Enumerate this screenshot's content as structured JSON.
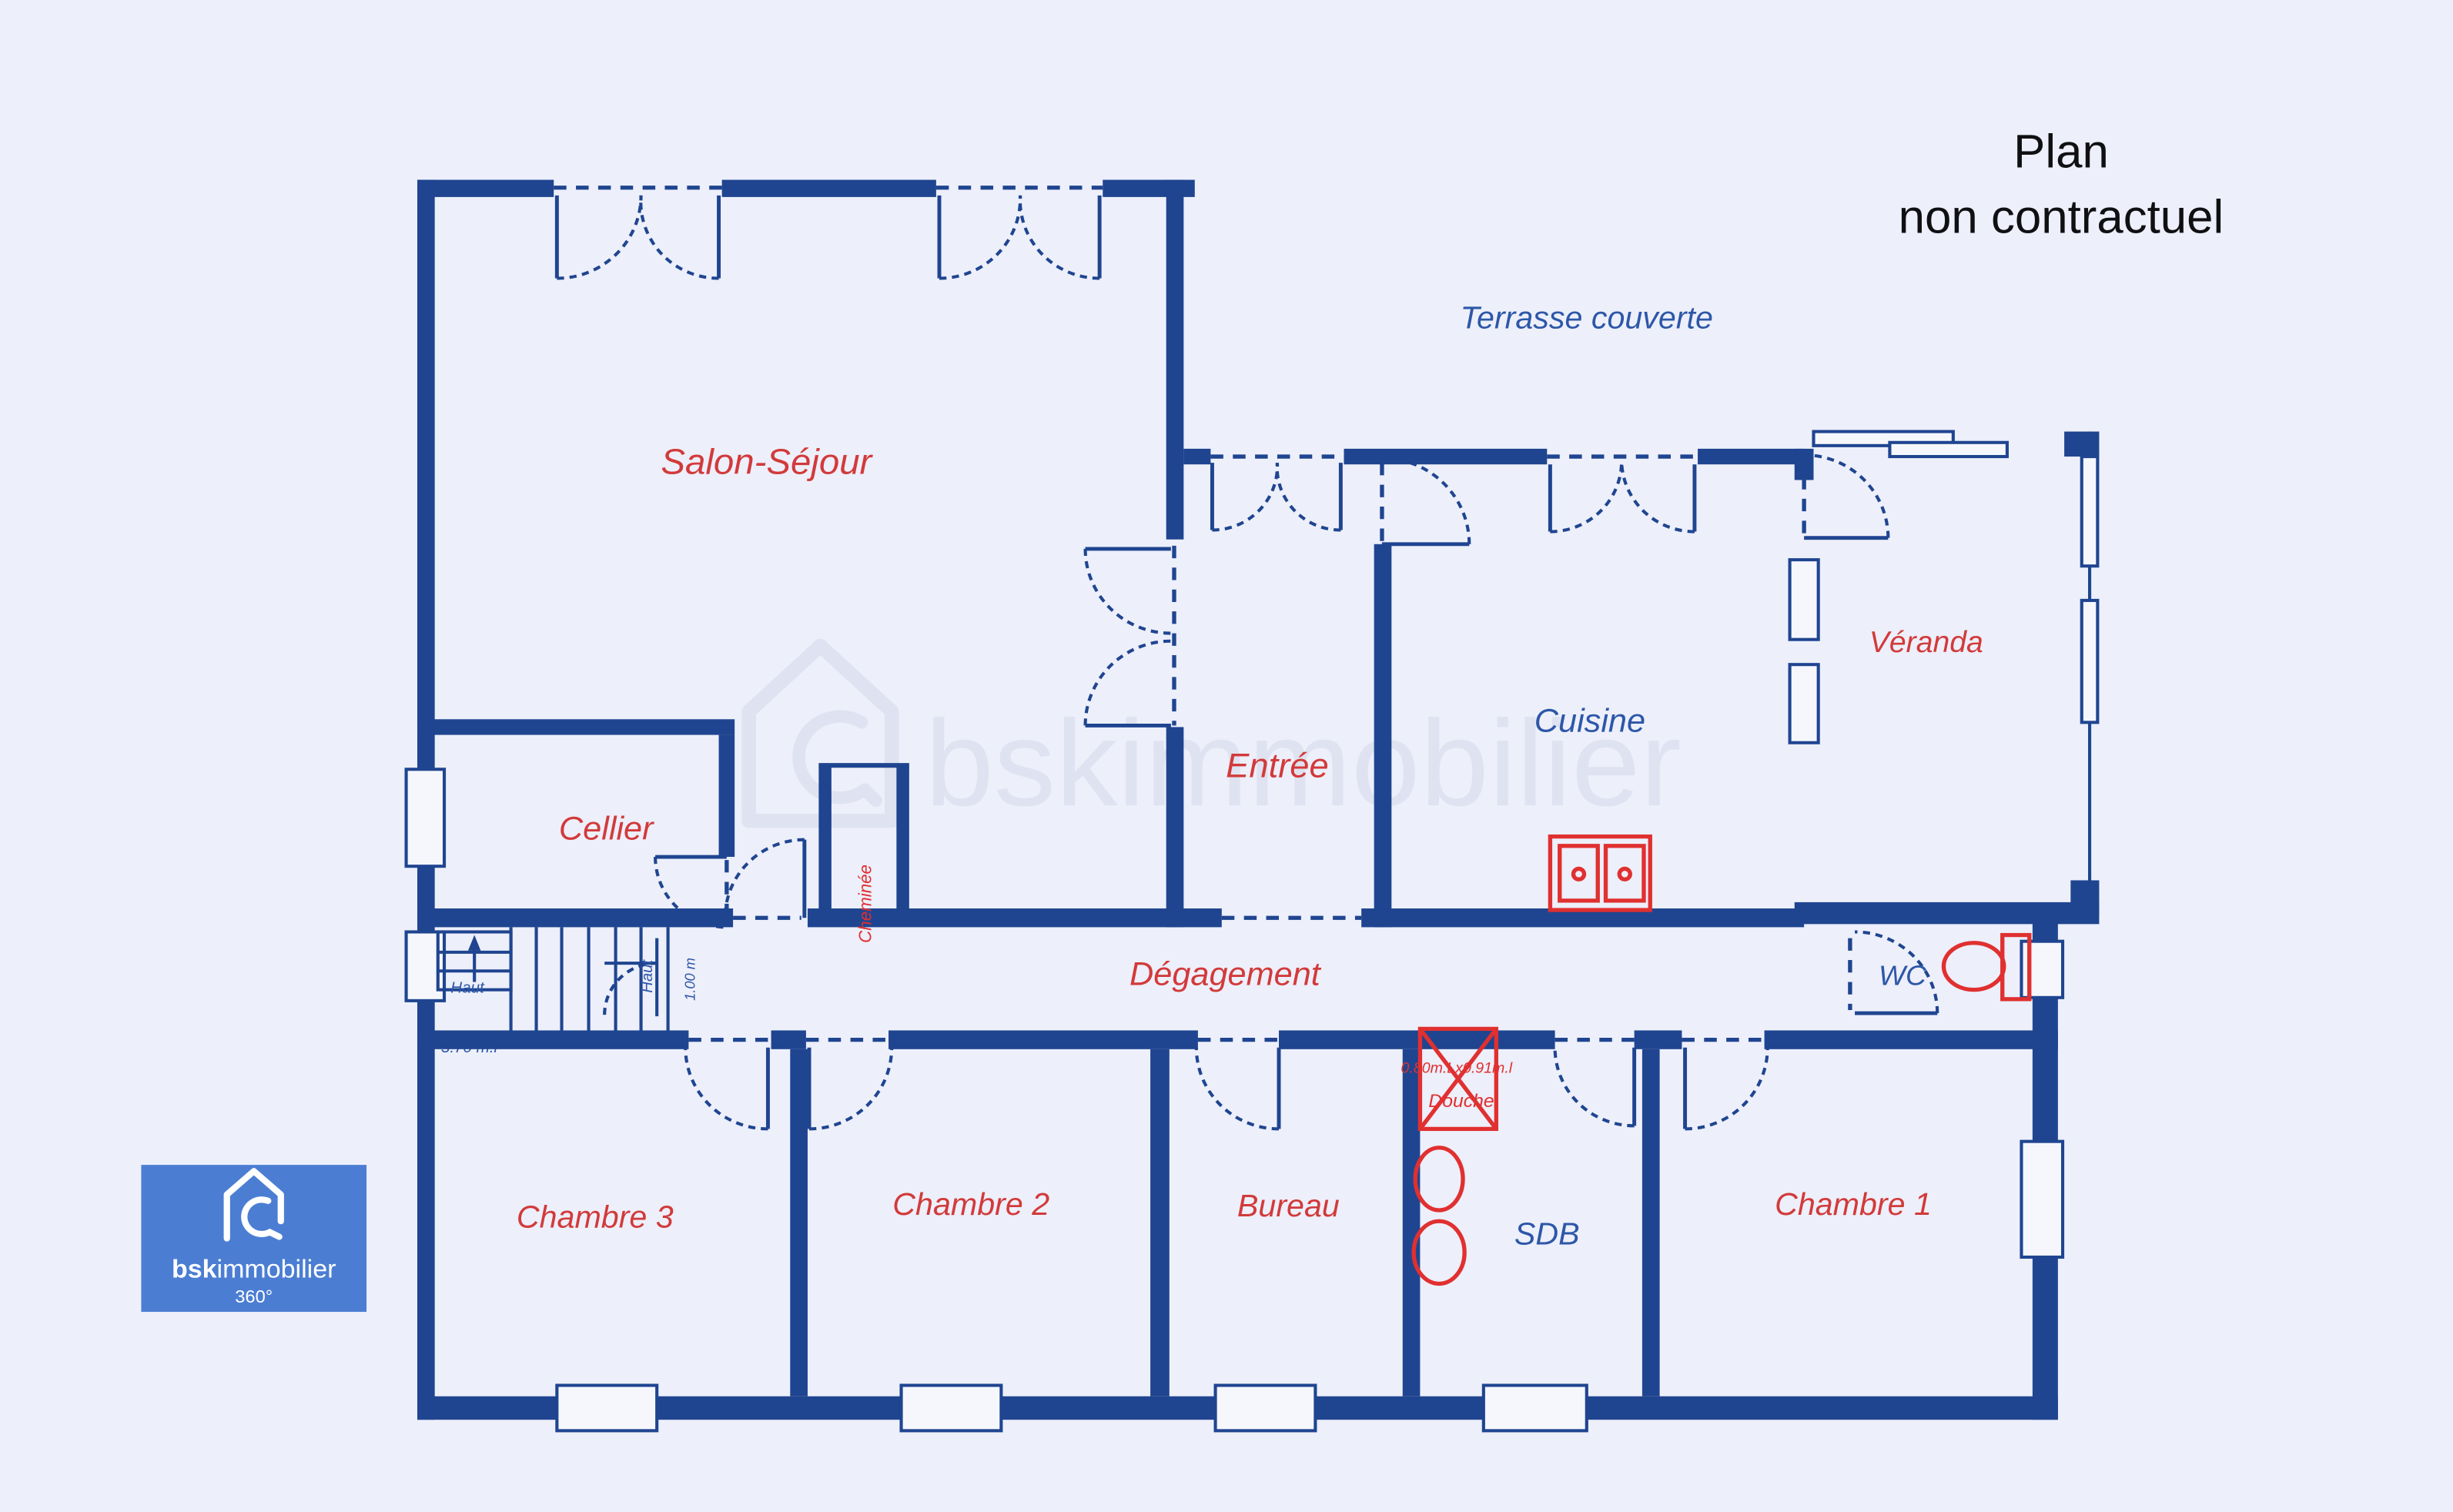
{
  "title": {
    "line1": "Plan",
    "line2": "non contractuel"
  },
  "watermark": "bskimmobilier",
  "logo": {
    "brand_bold": "bsk",
    "brand_rest": "immobilier",
    "badge": "360°"
  },
  "rooms": {
    "salon": "Salon-Séjour",
    "cellier": "Cellier",
    "cheminee": "Cheminée",
    "entree": "Entrée",
    "terrasse": "Terrasse couverte",
    "cuisine": "Cuisine",
    "veranda": "Véranda",
    "degagement": "Dégagement",
    "wc": "WC",
    "sdb": "SDB",
    "chambre1": "Chambre 1",
    "chambre2": "Chambre 2",
    "chambre3": "Chambre 3",
    "bureau": "Bureau"
  },
  "annotations": {
    "haut_left": "Haut",
    "haut_right": "Haut",
    "stair_width": "1.00 m",
    "partial_dimension": "3.70 m.l",
    "shower_dimensions": "0.80m.Lx0.91m.l",
    "shower_label": "Douche"
  },
  "colors": {
    "background": "#edeffa",
    "wall_navy": "#1f4590",
    "room_label_red": "#d23a3a",
    "room_label_blue": "#2d57a8",
    "fixture_red": "#e03030",
    "watermark_gray": "#dfe2f0",
    "logo_blue": "#4b7ed3",
    "title_black": "#101013"
  }
}
